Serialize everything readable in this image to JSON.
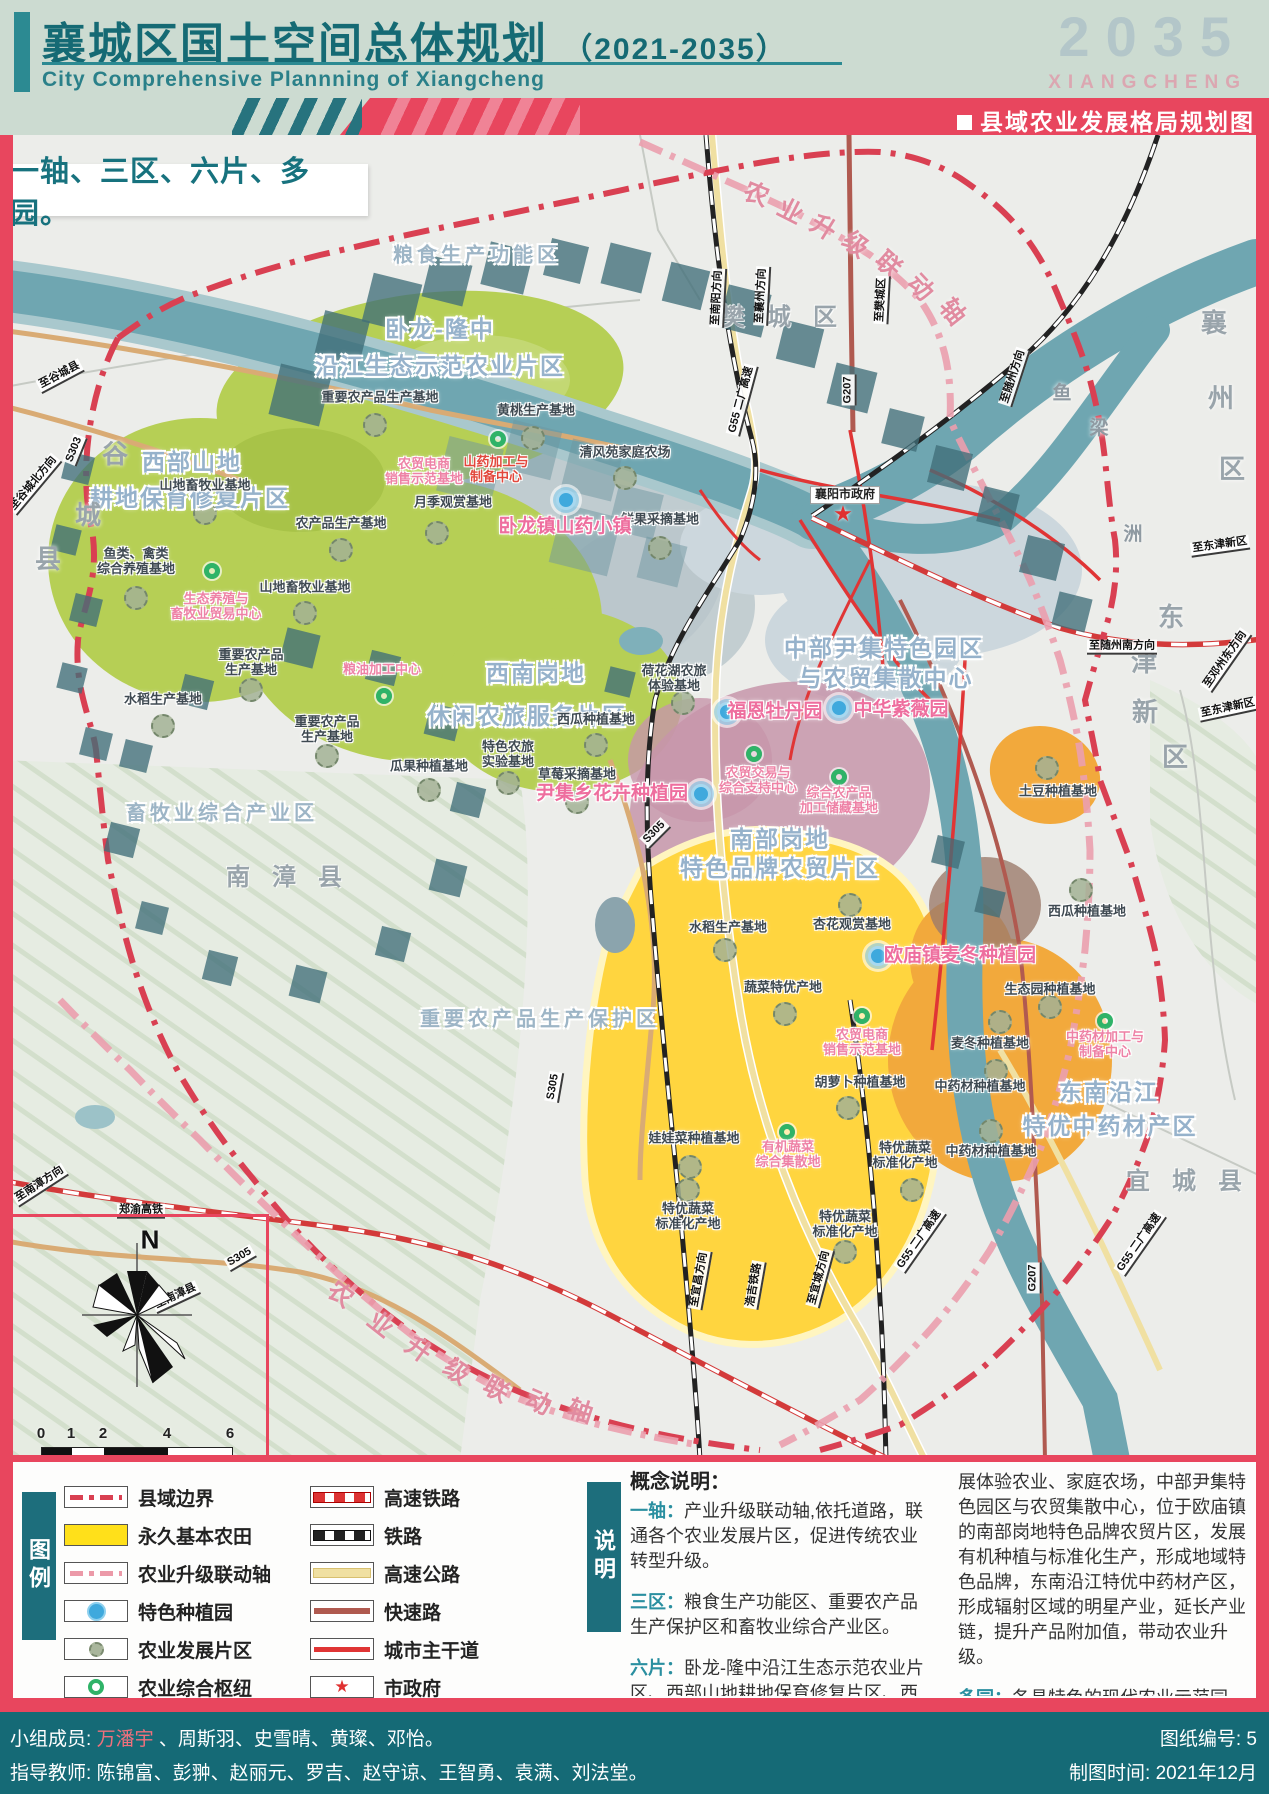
{
  "header": {
    "title": "襄城区国土空间总体规划",
    "paren": "（2021-2035）",
    "subtitle_en": "City Comprehensive Plannning of Xiangcheng",
    "year": "2035",
    "city_en": "XIANGCHENG",
    "banner_title": "县域农业发展格局规划图"
  },
  "map": {
    "slogan": "一轴、三区、六片、多园。",
    "compass_n": "N",
    "scalebar": {
      "ticks": [
        {
          "v": "0",
          "x": 41
        },
        {
          "v": "1",
          "x": 71
        },
        {
          "v": "2",
          "x": 103
        },
        {
          "v": "4",
          "x": 167
        },
        {
          "v": "6",
          "x": 230
        }
      ]
    },
    "labels": [
      {
        "t": "粮食生产功能区",
        "x": 477,
        "y": 256,
        "c": "bigsm"
      },
      {
        "t": "卧龙-隆中",
        "x": 440,
        "y": 329,
        "c": "big"
      },
      {
        "t": "沿江生态示范农业片区",
        "x": 440,
        "y": 366,
        "c": "big"
      },
      {
        "t": "西部山地",
        "x": 192,
        "y": 462,
        "c": "big"
      },
      {
        "t": "耕地保育修复片区",
        "x": 190,
        "y": 498,
        "c": "big"
      },
      {
        "t": "西南岗地",
        "x": 536,
        "y": 673,
        "c": "big"
      },
      {
        "t": "休闲农旅服务片区",
        "x": 527,
        "y": 716,
        "c": "big"
      },
      {
        "t": "中部尹集特色园区",
        "x": 884,
        "y": 648,
        "c": "big"
      },
      {
        "t": "与农贸集散中心",
        "x": 886,
        "y": 678,
        "c": "big"
      },
      {
        "t": "南部岗地",
        "x": 780,
        "y": 839,
        "c": "big"
      },
      {
        "t": "特色品牌农贸片区",
        "x": 780,
        "y": 868,
        "c": "big"
      },
      {
        "t": "东南沿江",
        "x": 1109,
        "y": 1092,
        "c": "big"
      },
      {
        "t": "特优中药材产区",
        "x": 1110,
        "y": 1126,
        "c": "big"
      },
      {
        "t": "畜牧业综合产业区",
        "x": 222,
        "y": 814,
        "c": "bigsm"
      },
      {
        "t": "重要农产品生产保护区",
        "x": 540,
        "y": 1020,
        "c": "bigsm"
      },
      {
        "t": "南漳县",
        "x": 295,
        "y": 878,
        "c": "county"
      },
      {
        "t": "樊城区",
        "x": 790,
        "y": 318,
        "c": "county"
      },
      {
        "t": "宜城县",
        "x": 1195,
        "y": 1182,
        "c": "county"
      },
      {
        "t": "谷",
        "x": 115,
        "y": 455,
        "c": "cty"
      },
      {
        "t": "城",
        "x": 88,
        "y": 516,
        "c": "cty"
      },
      {
        "t": "县",
        "x": 48,
        "y": 560,
        "c": "cty"
      },
      {
        "t": "襄",
        "x": 1214,
        "y": 324,
        "c": "cty"
      },
      {
        "t": "州",
        "x": 1221,
        "y": 399,
        "c": "cty"
      },
      {
        "t": "区",
        "x": 1232,
        "y": 470,
        "c": "cty"
      },
      {
        "t": "东",
        "x": 1171,
        "y": 618,
        "c": "cty"
      },
      {
        "t": "津",
        "x": 1144,
        "y": 663,
        "c": "cty"
      },
      {
        "t": "新",
        "x": 1145,
        "y": 713,
        "c": "cty"
      },
      {
        "t": "区",
        "x": 1175,
        "y": 758,
        "c": "cty"
      },
      {
        "t": "鱼",
        "x": 1062,
        "y": 394,
        "c": "ctysm"
      },
      {
        "t": "梁",
        "x": 1099,
        "y": 429,
        "c": "ctysm"
      },
      {
        "t": "洲",
        "x": 1133,
        "y": 535,
        "c": "ctysm"
      },
      {
        "t": "重要农产品生产基地",
        "x": 380,
        "y": 398,
        "c": "base"
      },
      {
        "t": "黄桃生产基地",
        "x": 536,
        "y": 411,
        "c": "base"
      },
      {
        "t": "清风苑家庭农场",
        "x": 625,
        "y": 453,
        "c": "base"
      },
      {
        "t": "月季观赏基地",
        "x": 453,
        "y": 503,
        "c": "base"
      },
      {
        "t": "鲜果采摘基地",
        "x": 660,
        "y": 520,
        "c": "base"
      },
      {
        "t": "山地畜牧业基地",
        "x": 205,
        "y": 486,
        "c": "base"
      },
      {
        "t": "农产品生产基地",
        "x": 341,
        "y": 524,
        "c": "base"
      },
      {
        "t": "山地畜牧业基地",
        "x": 305,
        "y": 588,
        "c": "base"
      },
      {
        "t": "鱼类、禽类\n综合养殖基地",
        "x": 136,
        "y": 562,
        "c": "base"
      },
      {
        "t": "重要农产品\n生产基地",
        "x": 251,
        "y": 663,
        "c": "base"
      },
      {
        "t": "水稻生产基地",
        "x": 163,
        "y": 700,
        "c": "base"
      },
      {
        "t": "重要农产品\n生产基地",
        "x": 327,
        "y": 730,
        "c": "base"
      },
      {
        "t": "瓜果种植基地",
        "x": 429,
        "y": 767,
        "c": "base"
      },
      {
        "t": "特色农旅\n实验基地",
        "x": 508,
        "y": 755,
        "c": "base"
      },
      {
        "t": "西瓜种植基地",
        "x": 596,
        "y": 720,
        "c": "base"
      },
      {
        "t": "草莓采摘基地",
        "x": 577,
        "y": 775,
        "c": "base"
      },
      {
        "t": "荷花湖农旅\n体验基地",
        "x": 674,
        "y": 679,
        "c": "base"
      },
      {
        "t": "水稻生产基地",
        "x": 728,
        "y": 928,
        "c": "base"
      },
      {
        "t": "杏花观赏基地",
        "x": 852,
        "y": 925,
        "c": "base"
      },
      {
        "t": "蔬菜特优产地",
        "x": 783,
        "y": 988,
        "c": "base"
      },
      {
        "t": "胡萝卜种植基地",
        "x": 860,
        "y": 1083,
        "c": "base"
      },
      {
        "t": "娃娃菜种植基地",
        "x": 694,
        "y": 1139,
        "c": "base"
      },
      {
        "t": "特优蔬菜\n标准化产地",
        "x": 688,
        "y": 1217,
        "c": "base"
      },
      {
        "t": "特优蔬菜\n标准化产地",
        "x": 845,
        "y": 1225,
        "c": "base"
      },
      {
        "t": "特优蔬菜\n标准化产地",
        "x": 905,
        "y": 1156,
        "c": "base"
      },
      {
        "t": "土豆种植基地",
        "x": 1058,
        "y": 792,
        "c": "base"
      },
      {
        "t": "西瓜种植基地",
        "x": 1087,
        "y": 912,
        "c": "base"
      },
      {
        "t": "生态园种植基地",
        "x": 1050,
        "y": 990,
        "c": "base"
      },
      {
        "t": "麦冬种植基地",
        "x": 990,
        "y": 1044,
        "c": "base"
      },
      {
        "t": "中药材种植基地",
        "x": 980,
        "y": 1087,
        "c": "base"
      },
      {
        "t": "中药材种植基地",
        "x": 991,
        "y": 1152,
        "c": "base"
      },
      {
        "t": "农贸电商\n销售示范基地",
        "x": 424,
        "y": 472,
        "c": "pink"
      },
      {
        "t": "山药加工与\n制备中心",
        "x": 496,
        "y": 470,
        "c": "red"
      },
      {
        "t": "生态养殖与\n畜牧业贸易中心",
        "x": 216,
        "y": 607,
        "c": "pink"
      },
      {
        "t": "粮油加工中心",
        "x": 382,
        "y": 670,
        "c": "pink"
      },
      {
        "t": "农贸交易与\n综合支持中心",
        "x": 758,
        "y": 781,
        "c": "pink"
      },
      {
        "t": "综合农产品\n加工储藏基地",
        "x": 839,
        "y": 801,
        "c": "pink"
      },
      {
        "t": "农贸电商\n销售示范基地",
        "x": 862,
        "y": 1043,
        "c": "pink"
      },
      {
        "t": "有机蔬菜\n综合集散地",
        "x": 788,
        "y": 1155,
        "c": "pink"
      },
      {
        "t": "中药材加工与\n制备中心",
        "x": 1105,
        "y": 1045,
        "c": "pink"
      },
      {
        "t": "卧龙镇山药小镇",
        "x": 565,
        "y": 527,
        "c": "pinklg"
      },
      {
        "t": "尹集乡花卉种植园",
        "x": 612,
        "y": 794,
        "c": "pinklg"
      },
      {
        "t": "福恩牡丹园",
        "x": 775,
        "y": 712,
        "c": "pinklg"
      },
      {
        "t": "中华紫薇园",
        "x": 901,
        "y": 710,
        "c": "pinklg"
      },
      {
        "t": "欧庙镇麦冬种植园",
        "x": 960,
        "y": 956,
        "c": "pinklg"
      },
      {
        "t": "农",
        "x": 756,
        "y": 195,
        "c": "axis",
        "r": 22
      },
      {
        "t": "业",
        "x": 790,
        "y": 212,
        "c": "axis",
        "r": 27
      },
      {
        "t": "升",
        "x": 823,
        "y": 228,
        "c": "axis",
        "r": 32
      },
      {
        "t": "级",
        "x": 855,
        "y": 245,
        "c": "axis",
        "r": 37
      },
      {
        "t": "联",
        "x": 888,
        "y": 265,
        "c": "axis",
        "r": 42
      },
      {
        "t": "动",
        "x": 920,
        "y": 288,
        "c": "axis",
        "r": 47
      },
      {
        "t": "轴",
        "x": 952,
        "y": 312,
        "c": "axis",
        "r": 52
      },
      {
        "t": "农",
        "x": 340,
        "y": 1295,
        "c": "axis",
        "r": 38
      },
      {
        "t": "业",
        "x": 380,
        "y": 1325,
        "c": "axis",
        "r": 38
      },
      {
        "t": "升",
        "x": 418,
        "y": 1350,
        "c": "axis",
        "r": 36
      },
      {
        "t": "级",
        "x": 456,
        "y": 1372,
        "c": "axis",
        "r": 34
      },
      {
        "t": "联",
        "x": 496,
        "y": 1390,
        "c": "axis",
        "r": 30
      },
      {
        "t": "动",
        "x": 538,
        "y": 1403,
        "c": "axis",
        "r": 24
      },
      {
        "t": "轴",
        "x": 580,
        "y": 1412,
        "c": "axis",
        "r": 18
      },
      {
        "t": "至谷城县",
        "x": 60,
        "y": 376,
        "c": "dir",
        "r": -28
      },
      {
        "t": "S303",
        "x": 75,
        "y": 450,
        "c": "dir",
        "r": -68
      },
      {
        "t": "至谷城北方向",
        "x": 34,
        "y": 484,
        "c": "dir",
        "r": -50
      },
      {
        "t": "至南阳方向",
        "x": 718,
        "y": 298,
        "c": "dir",
        "r": -87
      },
      {
        "t": "至襄州方向",
        "x": 762,
        "y": 296,
        "c": "dir",
        "r": -87
      },
      {
        "t": "至樊城区",
        "x": 882,
        "y": 300,
        "c": "dir",
        "r": -87
      },
      {
        "t": "至随州方向",
        "x": 1014,
        "y": 377,
        "c": "dir",
        "r": -72
      },
      {
        "t": "G55 二广高速",
        "x": 742,
        "y": 400,
        "c": "dir",
        "r": -75
      },
      {
        "t": "G207",
        "x": 849,
        "y": 390,
        "c": "dir",
        "r": -90
      },
      {
        "t": "至东津新区",
        "x": 1220,
        "y": 546,
        "c": "dir",
        "r": -8
      },
      {
        "t": "至随州南方向",
        "x": 1122,
        "y": 647,
        "c": "dir",
        "r": 0
      },
      {
        "t": "至邓州东方向",
        "x": 1226,
        "y": 660,
        "c": "dir",
        "r": -55
      },
      {
        "t": "至东津新区",
        "x": 1228,
        "y": 709,
        "c": "dir",
        "r": -12
      },
      {
        "t": "至南漳方向",
        "x": 40,
        "y": 1185,
        "c": "dir",
        "r": -33
      },
      {
        "t": "郑渝高铁",
        "x": 141,
        "y": 1211,
        "c": "dir",
        "r": 0
      },
      {
        "t": "至南漳县",
        "x": 176,
        "y": 1297,
        "c": "dir",
        "r": -25
      },
      {
        "t": "S305",
        "x": 240,
        "y": 1258,
        "c": "dir",
        "r": -30
      },
      {
        "t": "S305",
        "x": 655,
        "y": 833,
        "c": "dir",
        "r": -45
      },
      {
        "t": "S305",
        "x": 554,
        "y": 1087,
        "c": "dir",
        "r": -80
      },
      {
        "t": "至宜昌方向",
        "x": 700,
        "y": 1280,
        "c": "dir",
        "r": -80
      },
      {
        "t": "浩吉铁路",
        "x": 755,
        "y": 1285,
        "c": "dir",
        "r": -80
      },
      {
        "t": "至宜城方向",
        "x": 820,
        "y": 1278,
        "c": "dir",
        "r": -75
      },
      {
        "t": "G55 二广高速",
        "x": 920,
        "y": 1240,
        "c": "dir",
        "r": -55
      },
      {
        "t": "G55 二广高速",
        "x": 1140,
        "y": 1243,
        "c": "dir",
        "r": -55
      },
      {
        "t": "G207",
        "x": 1034,
        "y": 1278,
        "c": "dir",
        "r": -90
      },
      {
        "t": "襄阳市政府",
        "x": 845,
        "y": 495,
        "c": "gov",
        "r": 0
      }
    ],
    "markers": {
      "planting": [
        [
          566,
          500
        ],
        [
          727,
          712
        ],
        [
          839,
          708
        ],
        [
          701,
          794
        ],
        [
          878,
          956
        ]
      ],
      "hubs": [
        [
          498,
          439
        ],
        [
          212,
          571
        ],
        [
          384,
          696
        ],
        [
          754,
          754
        ],
        [
          839,
          777
        ],
        [
          862,
          1016
        ],
        [
          787,
          1132
        ],
        [
          1105,
          1021
        ]
      ],
      "zones": [
        [
          375,
          425
        ],
        [
          533,
          438
        ],
        [
          625,
          478
        ],
        [
          437,
          533
        ],
        [
          660,
          548
        ],
        [
          205,
          513
        ],
        [
          341,
          550
        ],
        [
          305,
          613
        ],
        [
          136,
          598
        ],
        [
          163,
          726
        ],
        [
          251,
          690
        ],
        [
          327,
          756
        ],
        [
          429,
          790
        ],
        [
          508,
          783
        ],
        [
          596,
          745
        ],
        [
          577,
          802
        ],
        [
          683,
          703
        ],
        [
          725,
          950
        ],
        [
          850,
          905
        ],
        [
          785,
          1014
        ],
        [
          848,
          1108
        ],
        [
          690,
          1167
        ],
        [
          688,
          1190
        ],
        [
          845,
          1252
        ],
        [
          912,
          1190
        ],
        [
          1047,
          768
        ],
        [
          1081,
          890
        ],
        [
          1050,
          1007
        ],
        [
          1000,
          1022
        ],
        [
          996,
          1071
        ],
        [
          991,
          1131
        ]
      ],
      "gov": [
        [
          843,
          514
        ]
      ]
    },
    "squares": [
      [
        300,
        395,
        52
      ],
      [
        342,
        338,
        46
      ],
      [
        392,
        303,
        50
      ],
      [
        447,
        281,
        42
      ],
      [
        507,
        268,
        44
      ],
      [
        566,
        261,
        38
      ],
      [
        626,
        268,
        42
      ],
      [
        686,
        286,
        40
      ],
      [
        745,
        311,
        44
      ],
      [
        800,
        344,
        40
      ],
      [
        852,
        388,
        42
      ],
      [
        903,
        430,
        36
      ],
      [
        950,
        468,
        38
      ],
      [
        998,
        508,
        36
      ],
      [
        1042,
        558,
        38
      ],
      [
        1072,
        612,
        34
      ],
      [
        78,
        468,
        28
      ],
      [
        66,
        540,
        26
      ],
      [
        86,
        610,
        28
      ],
      [
        72,
        678,
        26
      ],
      [
        96,
        744,
        28
      ],
      [
        470,
        470,
        56,
        1
      ],
      [
        532,
        450,
        50,
        1
      ],
      [
        592,
        470,
        52,
        1
      ],
      [
        636,
        512,
        46,
        1
      ],
      [
        662,
        562,
        42,
        1
      ],
      [
        585,
        540,
        60,
        1
      ],
      [
        300,
        648,
        34
      ],
      [
        383,
        668,
        30
      ],
      [
        443,
        722,
        32
      ],
      [
        468,
        800,
        30
      ],
      [
        448,
        878,
        32
      ],
      [
        393,
        944,
        30
      ],
      [
        308,
        984,
        32
      ],
      [
        220,
        968,
        30
      ],
      [
        152,
        918,
        28
      ],
      [
        122,
        840,
        30
      ],
      [
        136,
        756,
        28
      ],
      [
        196,
        692,
        30
      ],
      [
        620,
        682,
        26
      ],
      [
        948,
        852,
        28
      ],
      [
        990,
        902,
        26
      ]
    ]
  },
  "legend": {
    "tab": "图例",
    "left": [
      {
        "label": "县域边界"
      },
      {
        "label": "永久基本农田"
      },
      {
        "label": "农业升级联动轴"
      },
      {
        "label": "特色种植园"
      },
      {
        "label": "农业发展片区"
      },
      {
        "label": "农业综合枢纽"
      }
    ],
    "right": [
      {
        "label": "高速铁路"
      },
      {
        "label": "铁路"
      },
      {
        "label": "高速公路"
      },
      {
        "label": "快速路"
      },
      {
        "label": "城市主干道"
      },
      {
        "label": "市政府"
      }
    ],
    "star": "★"
  },
  "notes": {
    "tab": "说明",
    "heading": "概念说明：",
    "items": [
      {
        "term": "一轴：",
        "text": "产业升级联动轴,依托道路，联通各个农业发展片区，促进传统农业转型升级。"
      },
      {
        "term": "三区：",
        "text": "粮食生产功能区、重要农产品生产保护区和畜牧业综合产业区。"
      },
      {
        "term": "六片：",
        "text": "卧龙-隆中沿江生态示范农业片区、西部山地耕地保育修复片区、西南岗地休闲农旅服务片区，大力发"
      },
      {
        "term": "多园：",
        "text": "各具特色的现代农业示范园区、特色农作物集中生产地。"
      }
    ],
    "continuation": "展体验农业、家庭农场，中部尹集特色园区与农贸集散中心，位于欧庙镇的南部岗地特色品牌农贸片区，发展有机种植与标准化生产，形成地域特色品牌，东南沿江特优中药材产区，形成辐射区域的明星产业，延长产业链，提升产品附加值，带动农业升级。"
  },
  "footer": {
    "members_label": "小组成员:",
    "members_highlight": "万潘宇",
    "members_rest": "、周斯羽、史雪晴、黄璨、邓怡。",
    "teachers_label": "指导教师:",
    "teachers": "陈锦富、彭翀、赵丽元、罗吉、赵守谅、王智勇、袁满、刘法堂。",
    "sheet_no": "图纸编号: 5",
    "date": "制图时间: 2021年12月"
  }
}
